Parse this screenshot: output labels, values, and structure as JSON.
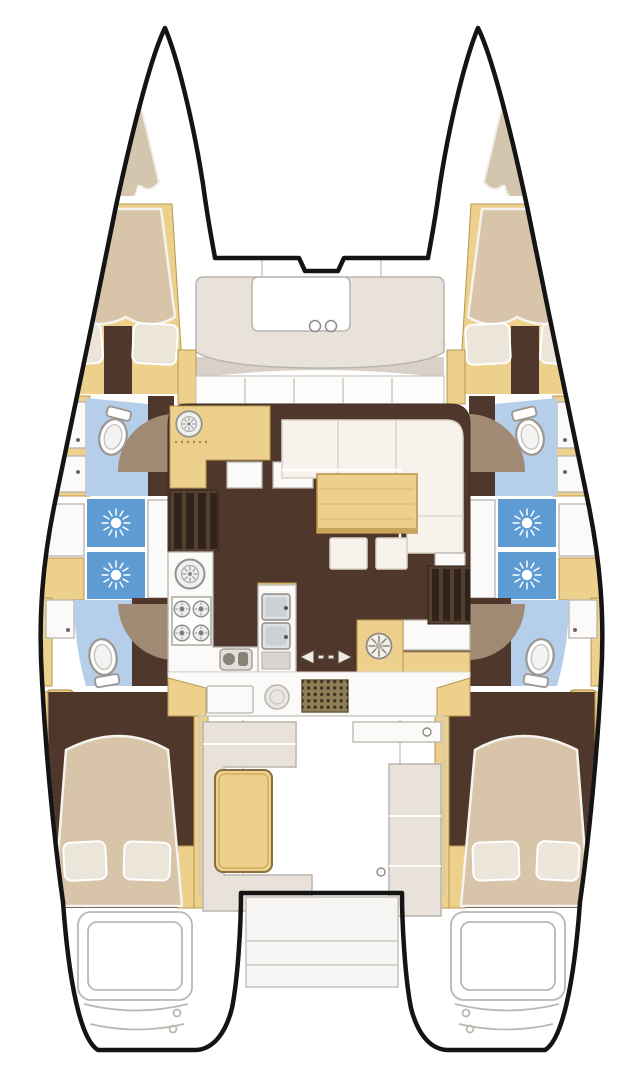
{
  "title": "Catamaran floor plan — top view, 4 cabins / 4 heads",
  "diagram_type": "boat-deck-plan",
  "colors": {
    "outline": "#141414",
    "deck_line": "#cbc8c2",
    "wood_floor": "#4f382b",
    "wood_mid": "#55402f",
    "wood_dark": "#2f231c",
    "joinery_tan": "#ecd08c",
    "tan_edge": "#b7984f",
    "berth_beige": "#d7c4a9",
    "berth_edge": "#f6f3ee",
    "pillow": "#ece5d9",
    "settee_cream": "#f7f3ec",
    "cream_edge": "#d9d2c6",
    "bath_floor_blue": "#b5cee9",
    "shower_blue": "#5e9bd3",
    "furniture_white": "#fbfaf8",
    "gray_edge": "#b9b4ad",
    "gray_dark": "#8e8982",
    "step_taupe": "#a08a73",
    "bench_gray": "#e8e2db",
    "grate_brown": "#8f7f57",
    "grate_dot": "#3d3422",
    "table_edge": "#b8934b",
    "hatch_dark": "#453428"
  },
  "spaces": [
    {
      "id": "trampoline",
      "label": "foredeck trampoline between bows"
    },
    {
      "id": "forepeak-port",
      "label": "port forepeak sunpad"
    },
    {
      "id": "forepeak-starboard",
      "label": "starboard forepeak sunpad"
    },
    {
      "id": "forward-cockpit",
      "label": "forward cockpit bench with footwell and 2 cupholders"
    },
    {
      "id": "windshield",
      "label": "salon windshield with 4 mullions"
    },
    {
      "id": "salon",
      "label": "salon with L-shaped settee, table and 2 ottomans"
    },
    {
      "id": "galley",
      "label": "galley: forward counter with round sink, inline counter with round sink, 4-burner stove, faucet module, island with double sink, aft counter with round hob"
    },
    {
      "id": "companionway-port",
      "label": "steps down to port hull"
    },
    {
      "id": "companionway-starboard",
      "label": "steps down to starboard hull"
    },
    {
      "id": "sliding-door",
      "label": "sliding door to cockpit (arrow marks)"
    },
    {
      "id": "cockpit",
      "label": "aft cockpit with L-bench, table, side bench, deck grate"
    },
    {
      "id": "transom-platform",
      "label": "transom platform between sterns"
    },
    {
      "id": "forward-cabin-port",
      "label": "port forward double cabin"
    },
    {
      "id": "forward-cabin-starboard",
      "label": "starboard forward double cabin"
    },
    {
      "id": "forward-head-port",
      "label": "port forward head: toilet, vanities, shower pans"
    },
    {
      "id": "forward-head-starboard",
      "label": "starboard forward head: toilet, vanities, shower pans"
    },
    {
      "id": "aft-head-port",
      "label": "port aft head: toilet, vanity"
    },
    {
      "id": "aft-head-starboard",
      "label": "starboard aft head: toilet, vanity"
    },
    {
      "id": "aft-cabin-port",
      "label": "port aft double cabin"
    },
    {
      "id": "aft-cabin-starboard",
      "label": "starboard aft double cabin"
    },
    {
      "id": "stern-steps-port",
      "label": "port swim steps"
    },
    {
      "id": "stern-steps-starboard",
      "label": "starboard swim steps"
    }
  ],
  "fixtures": {
    "toilets": 4,
    "shower_pans_with_sun_drain": 4,
    "deck_hatch_icons": 4,
    "stove_burners": 4,
    "round_sinks": 2,
    "double_sink_bowls": 2,
    "round_hob": 1,
    "cupholders": 2,
    "pillows": 8,
    "ottomans": 2
  },
  "icons": [
    "shower-drain-sun-icon",
    "deck-hatch-fan-icon",
    "round-sink-icon",
    "burner-icon",
    "toilet-icon",
    "faucet-icon",
    "sliding-door-arrows-icon",
    "cupholder-icon"
  ]
}
